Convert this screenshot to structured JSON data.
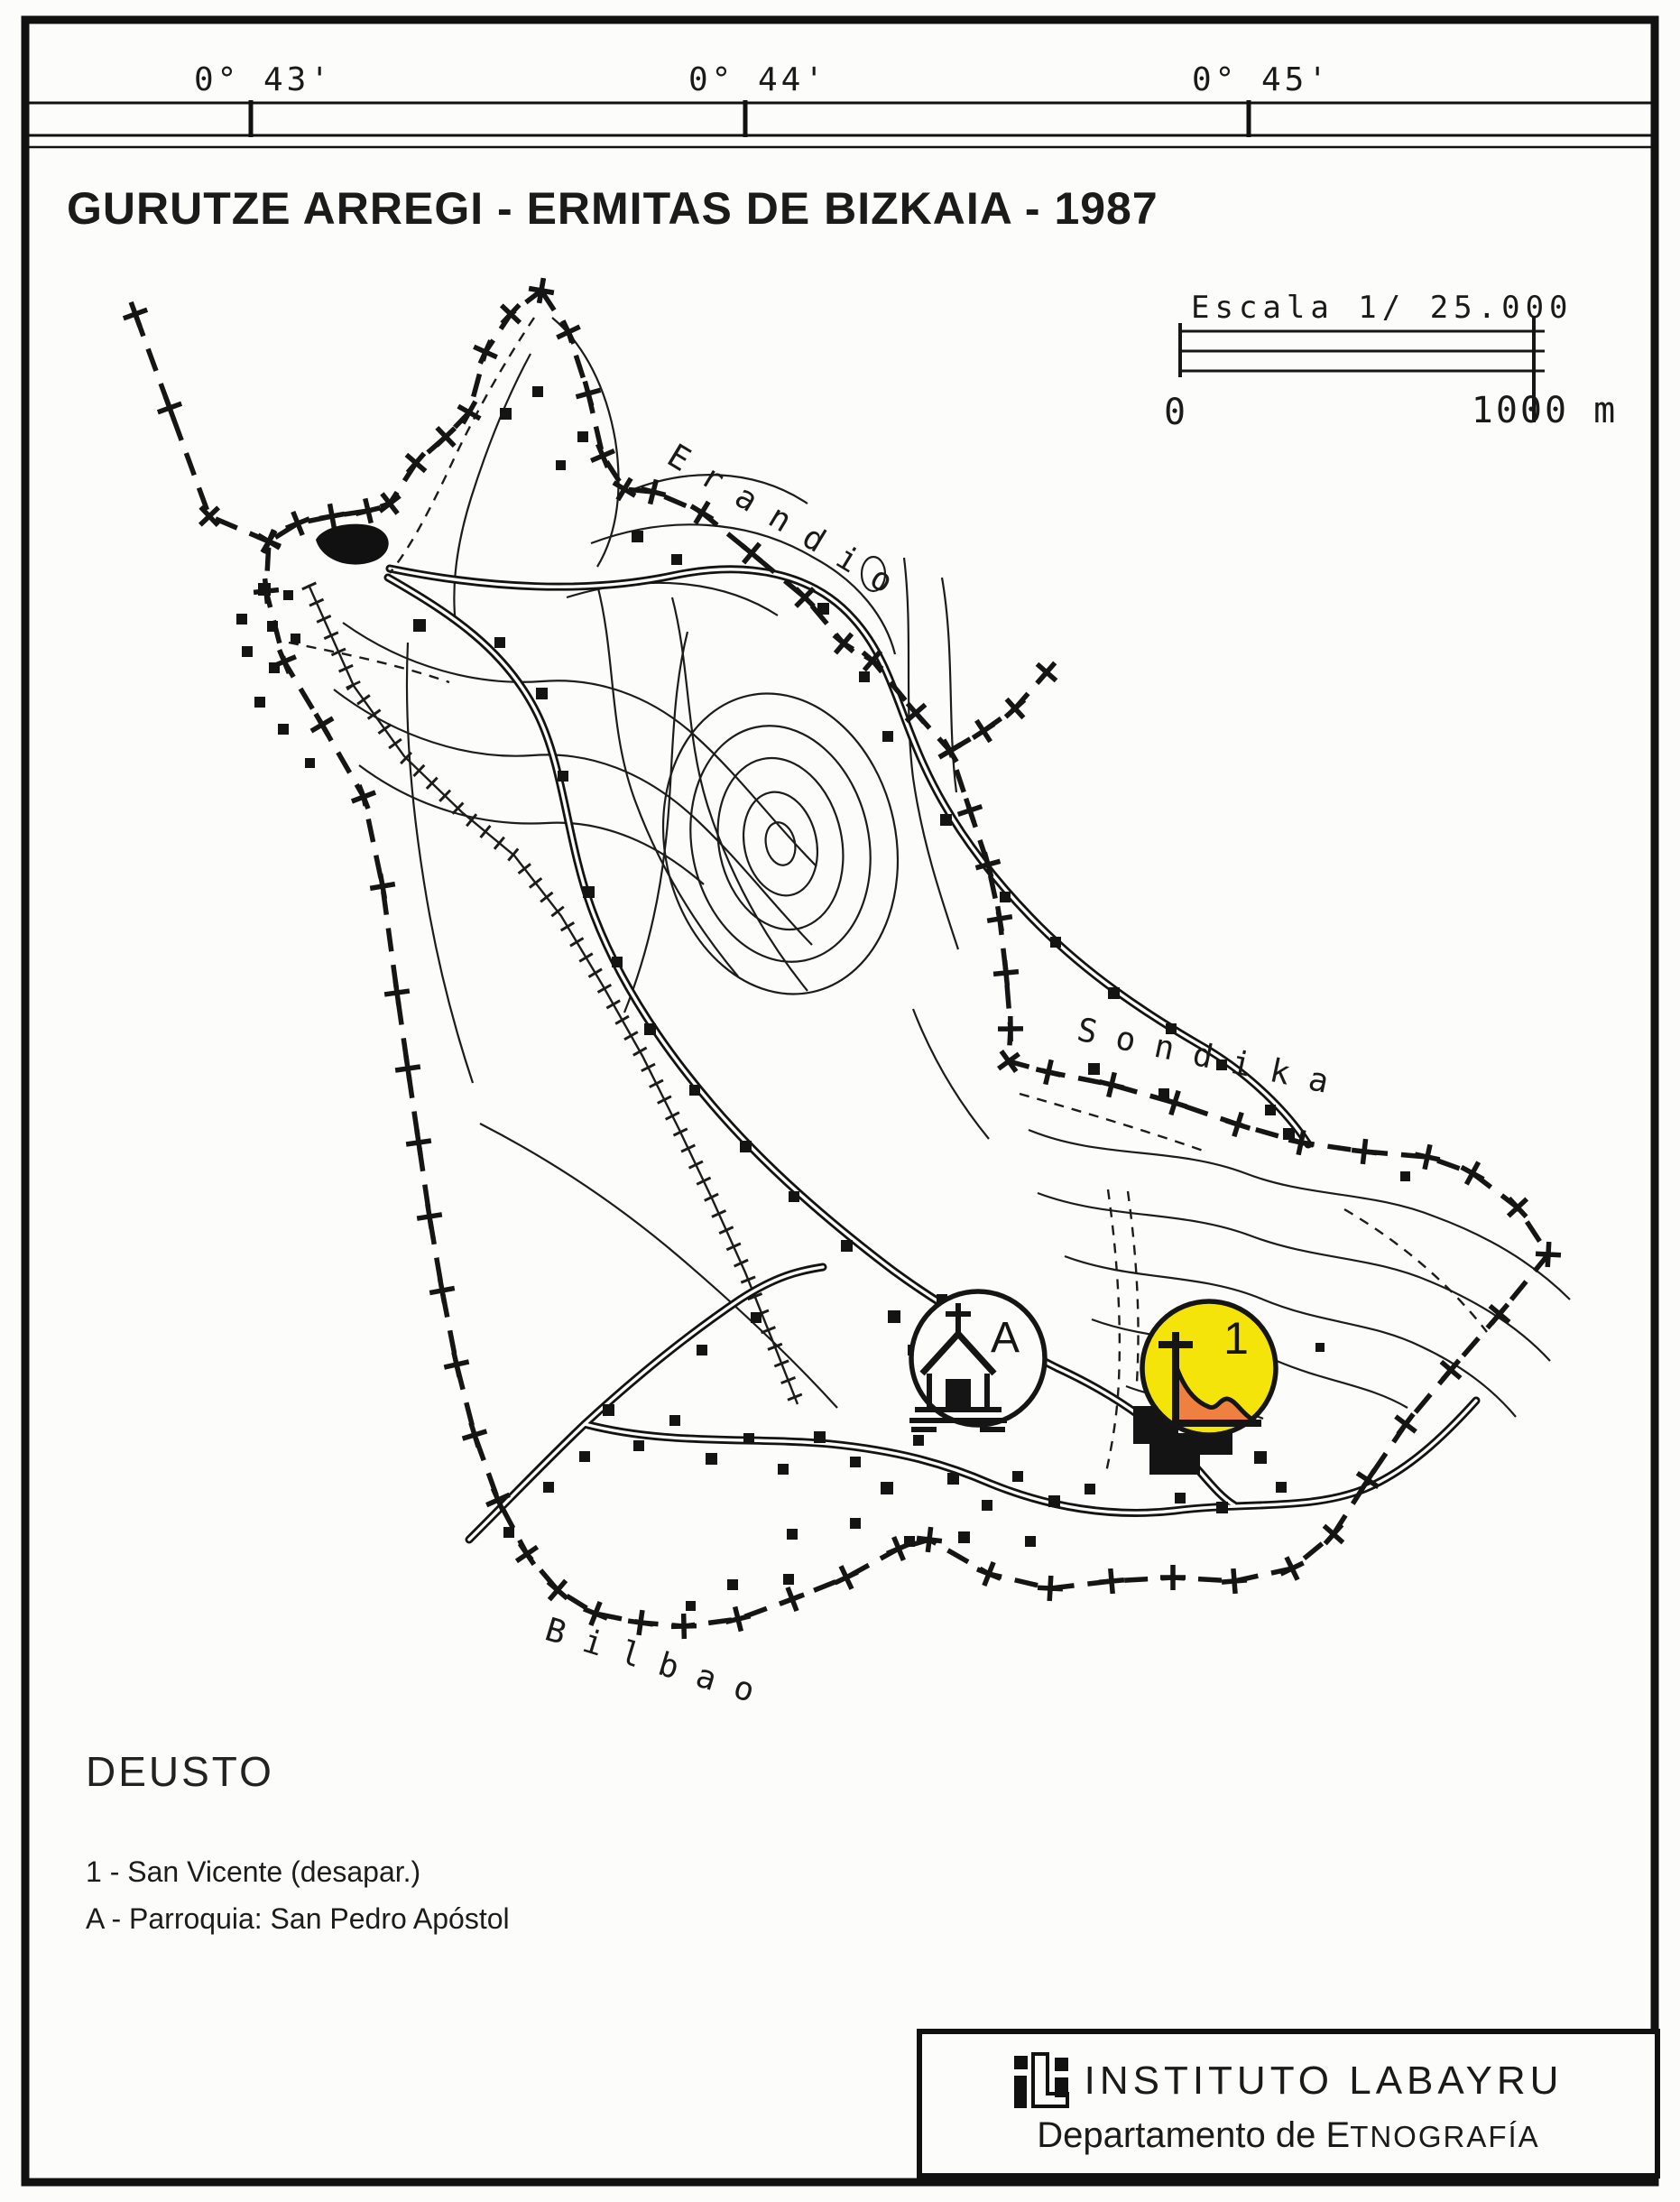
{
  "header": {
    "title": "GURUTZE ARREGI - ERMITAS DE BIZKAIA - 1987",
    "coordinates": [
      "0° 43'",
      "0° 44'",
      "0° 45'"
    ]
  },
  "scale": {
    "label": "Escala 1/ 25.000",
    "min": "0",
    "max": "1000 m"
  },
  "map": {
    "neighbor_labels": {
      "erandio": "Erandio",
      "sondika": "Sondika",
      "bilbao": "Bilbao"
    },
    "markers": {
      "parroquia": {
        "letter": "A"
      },
      "ermita": {
        "number": "1"
      }
    },
    "colors": {
      "ermita_fill": "#F4E409",
      "ermita_hill": "#EF8040",
      "ink": "#151515"
    }
  },
  "legend": {
    "district": "DEUSTO",
    "entries": [
      "1 - San Vicente (desapar.)",
      "A - Parroquia: San Pedro Apóstol"
    ]
  },
  "footer": {
    "institute": "INSTITUTO LABAYRU",
    "department": "Departamento de ",
    "department_name_initial": "E",
    "department_name_rest": "TNOGRAFÍA"
  }
}
